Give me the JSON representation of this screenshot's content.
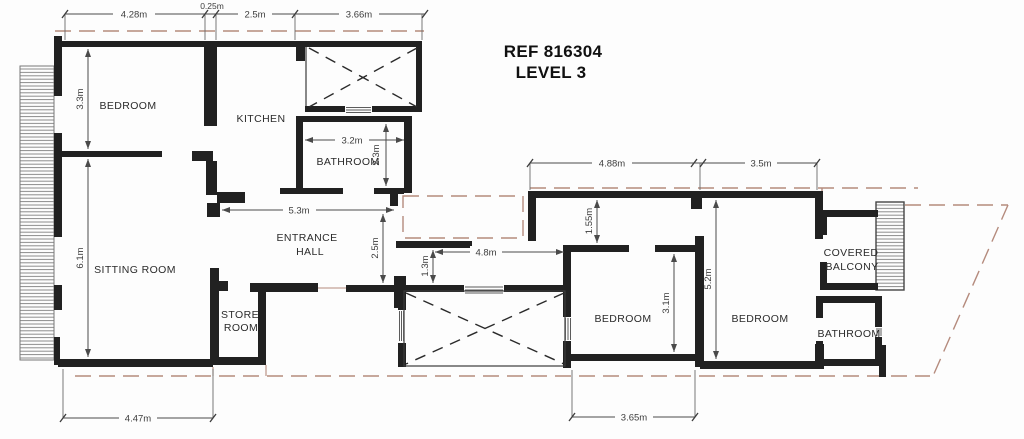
{
  "title": {
    "line1": "REF 816304",
    "line2": "LEVEL 3"
  },
  "rooms": {
    "bedroom_left": "BEDROOM",
    "kitchen": "KITCHEN",
    "bathroom_left": "BATHROOM",
    "entrance_hall": [
      "ENTRANCE",
      "HALL"
    ],
    "sitting_room": "SITTING ROOM",
    "store_room": [
      "STORE",
      "ROOM"
    ],
    "bedroom_mid": "BEDROOM",
    "bedroom_right": "BEDROOM",
    "covered_balcony": [
      "COVERED",
      "BALCONY"
    ],
    "bathroom_right": "BATHROOM"
  },
  "dimensions": {
    "top_a": "4.28m",
    "top_b": "0.25m",
    "top_c": "2.5m",
    "top_d": "3.66m",
    "bedroom_left_depth": "3.3m",
    "sitting_room_depth": "6.1m",
    "bathroom_left_width": "3.2m",
    "bathroom_left_depth": "2.3m",
    "entrance_hall_width": "5.3m",
    "courtyard_offset": "2.5m",
    "courtyard_step": "1.3m",
    "corridor_width": "4.8m",
    "right_top_a": "4.88m",
    "right_top_b": "3.5m",
    "right_offset": "1.55m",
    "bedroom_right_depth": "5.2m",
    "bedroom_mid_depth": "3.1m",
    "bottom_left_width": "4.47m",
    "bottom_mid_width": "3.65m"
  },
  "colors": {
    "wall": "#212121",
    "dimension": "#4a4a4a",
    "reference_dashed": "#b58b7d",
    "background": "#fdfdfd"
  }
}
